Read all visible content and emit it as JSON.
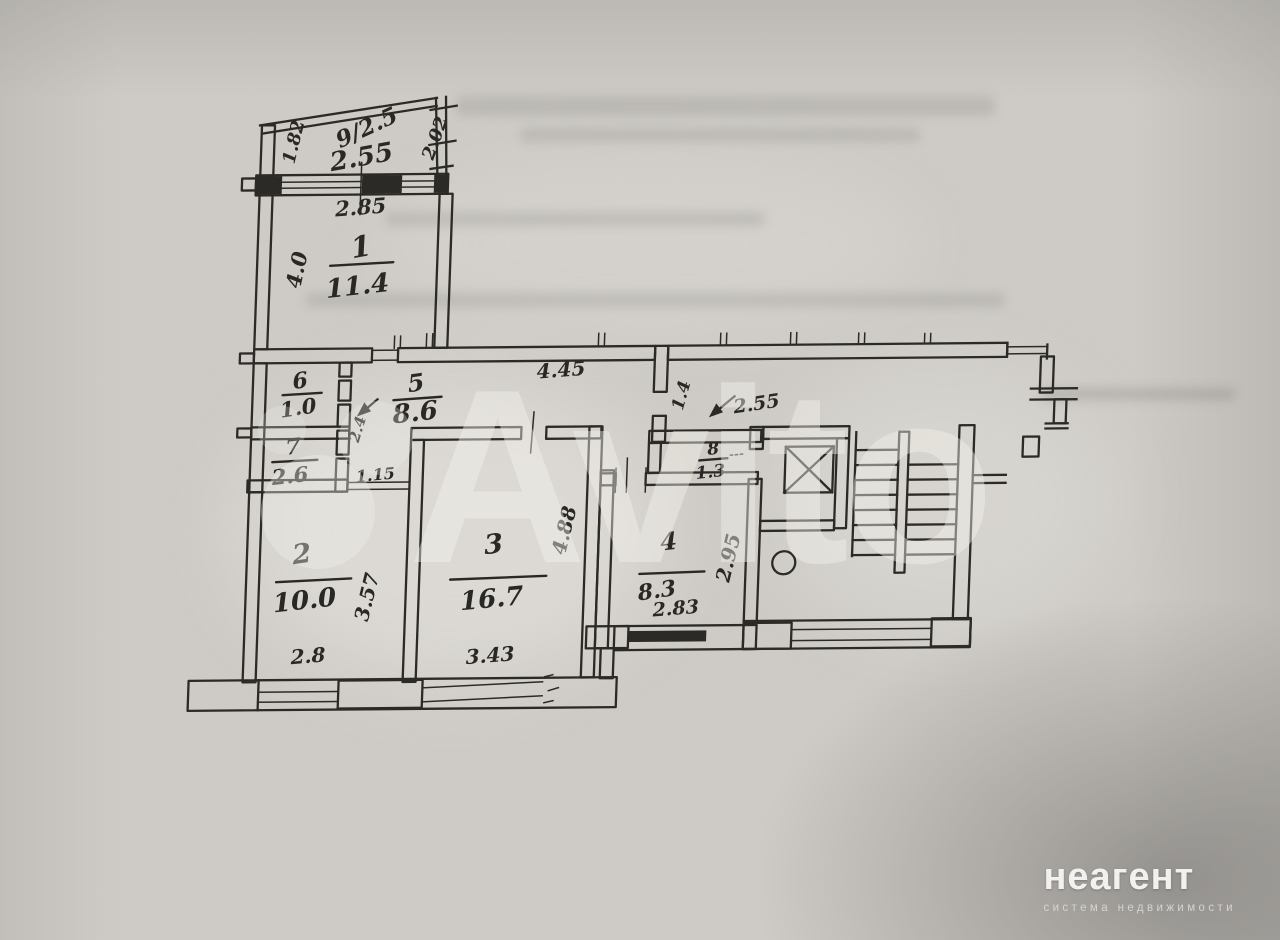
{
  "colors": {
    "paper": "#cecbc6",
    "ink": "#2c2a27",
    "watermark": "#f3f1eb",
    "logo_text": "#f2f1ef"
  },
  "watermark": {
    "brand": "Avito"
  },
  "agency": {
    "name": "неагент",
    "tagline": "система недвижимости"
  },
  "plan": {
    "balcony": {
      "label": "9/2.5",
      "width": "2.55",
      "side_left": "1.82",
      "side_right": "2.02"
    },
    "rooms": {
      "r1": {
        "number": "1",
        "area": "11.4",
        "width": "2.85",
        "depth": "4.0"
      },
      "r2": {
        "number": "2",
        "area": "10.0",
        "width": "2.8",
        "depth": "3.57"
      },
      "r3": {
        "number": "3",
        "area": "16.7",
        "width": "3.43",
        "depth": "4.88"
      },
      "r4": {
        "number": "4",
        "area": "8.3",
        "width": "2.83",
        "depth": "2.95"
      },
      "r5": {
        "number": "5",
        "area": "8.6",
        "length": "4.45",
        "width": "2.4"
      },
      "r6": {
        "number": "6",
        "area": "1.0"
      },
      "r7": {
        "number": "7",
        "area": "2.6"
      },
      "r8": {
        "number": "8",
        "area": "1.3"
      }
    },
    "openings": {
      "passage_room2": "1.15",
      "entry_width": "1.4",
      "entry_dim": "2.55"
    }
  }
}
